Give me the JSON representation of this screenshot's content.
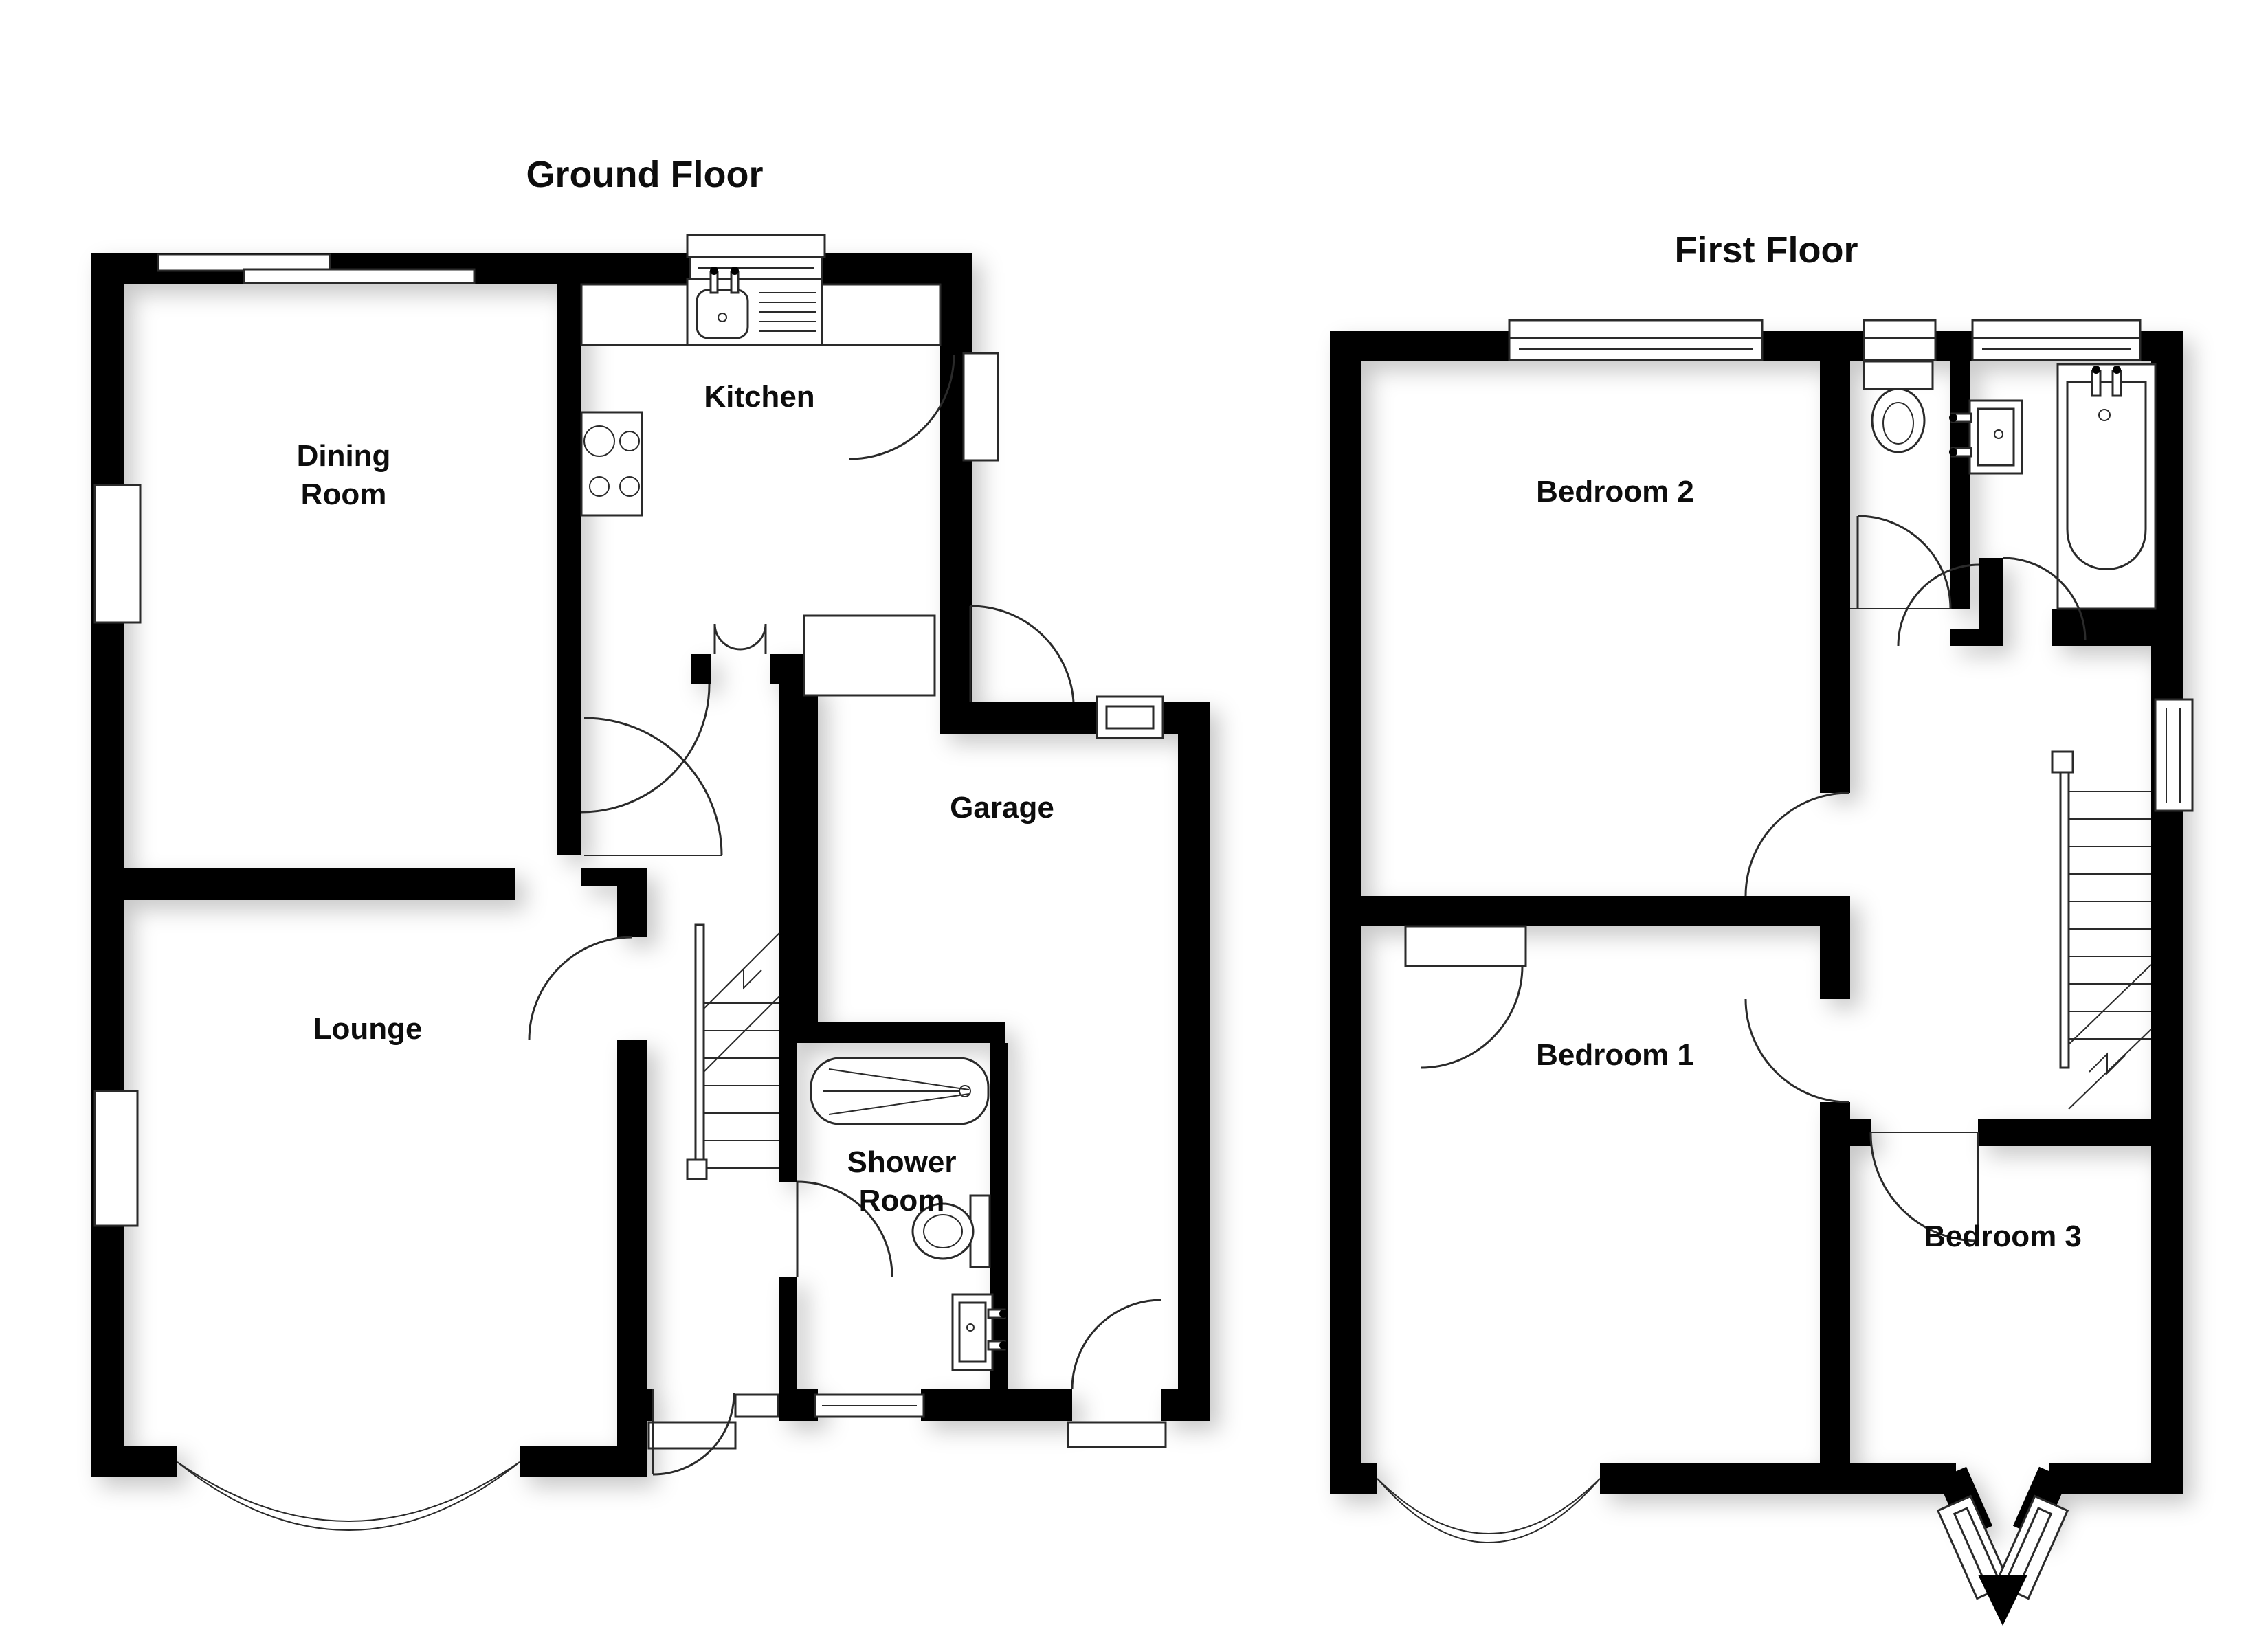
{
  "page": {
    "background": "#ffffff",
    "wall_color": "#000000",
    "line_color": "#2a2a2a",
    "label_color": "#0d0d0d"
  },
  "ground_floor": {
    "title": "Ground Floor",
    "rooms": {
      "dining_line1": "Dining",
      "dining_line2": "Room",
      "kitchen": "Kitchen",
      "lounge": "Lounge",
      "garage": "Garage",
      "shower_line1": "Shower",
      "shower_line2": "Room"
    }
  },
  "first_floor": {
    "title": "First Floor",
    "rooms": {
      "bedroom2": "Bedroom 2",
      "bedroom1": "Bedroom 1",
      "bedroom3": "Bedroom 3"
    }
  }
}
